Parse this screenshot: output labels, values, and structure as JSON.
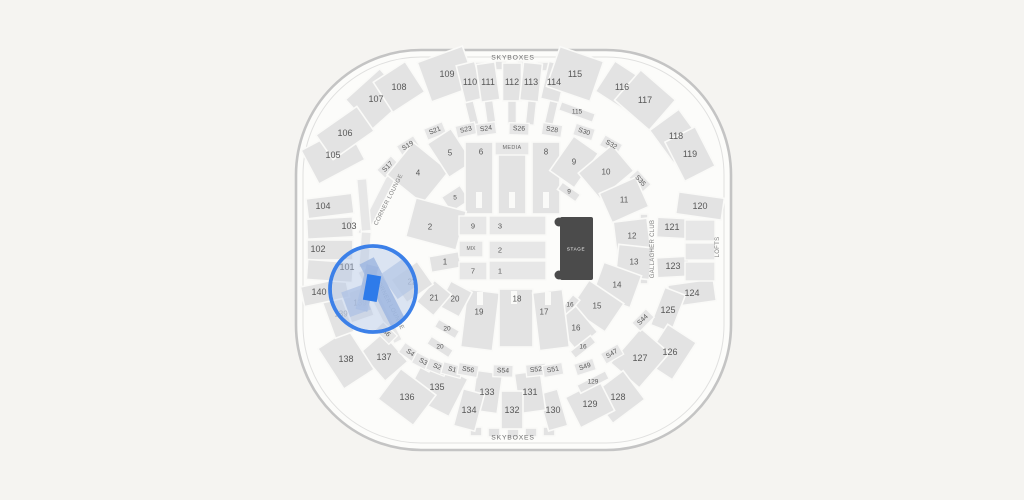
{
  "map": {
    "labels": {
      "skyboxes_top": "SKYBOXES",
      "skyboxes_bottom": "SKYBOXES",
      "corner_lounge_upper": "CORNER LOUNGE",
      "corner_lounge_lower": "CORNER LOUNGE",
      "gallagher_club": "GALLAGHER CLUB",
      "lofts": "LOFTS",
      "media": "MEDIA",
      "mix": "MIX",
      "stage": "STAGE"
    },
    "outer": {
      "s101": "101",
      "s102": "102",
      "s103": "103",
      "s104": "104",
      "s105": "105",
      "s106": "106",
      "s107": "107",
      "s108": "108",
      "s109": "109",
      "s110": "110",
      "s111": "111",
      "s112": "112",
      "s113": "113",
      "s114": "114",
      "s115": "115",
      "s115_arc": "115",
      "s116": "116",
      "s117": "117",
      "s118": "118",
      "s119": "119",
      "s120": "120",
      "s121": "121",
      "s123": "123",
      "s124": "124",
      "s125": "125",
      "s126": "126",
      "s127": "127",
      "s128": "128",
      "s129": "129",
      "s129_arc": "129",
      "s130": "130",
      "s131": "131",
      "s132": "132",
      "s133": "133",
      "s134": "134",
      "s135": "135",
      "s136": "136",
      "s137": "137",
      "s138": "138",
      "s139": "139",
      "s139_dim": "139",
      "s140": "140"
    },
    "suites": {
      "s17": "S17",
      "s19": "S19",
      "s21": "S21",
      "s23": "S23",
      "s24": "S24",
      "s26": "S26",
      "s28": "S28",
      "s30": "S30",
      "s32": "S32",
      "s35": "S35",
      "s44": "S44",
      "s47": "S47",
      "s49": "S49",
      "s51": "S51",
      "s52": "S52",
      "s54": "S54",
      "s56": "S56",
      "s1": "S1",
      "s2": "S2",
      "s3": "S3",
      "s4": "S4",
      "s6": "S6"
    },
    "inner": {
      "i1": "1",
      "i2": "2",
      "i4": "4",
      "i5": "5",
      "i5b": "5",
      "i6": "6",
      "i8": "8",
      "i9": "9",
      "i9b": "9",
      "i10": "10",
      "i11": "11",
      "i12": "12",
      "i13": "13",
      "i14": "14",
      "i15": "15",
      "i16": "16",
      "i16b": "16",
      "i16c": "16",
      "i17": "17",
      "i18": "18",
      "i19": "19",
      "i20": "20",
      "i20b": "20",
      "i20c": "20",
      "i21": "21",
      "i22": "22"
    },
    "floor": {
      "f9": "9",
      "f3": "3",
      "f2": "2",
      "f7": "7",
      "f1": "1"
    },
    "colors": {
      "background": "#f5f4f1",
      "section_fill": "#e3e3e3",
      "stage_fill": "#4b4b4b",
      "highlight_ring": "#3c80e8",
      "selected_block": "#2e7bea"
    }
  }
}
